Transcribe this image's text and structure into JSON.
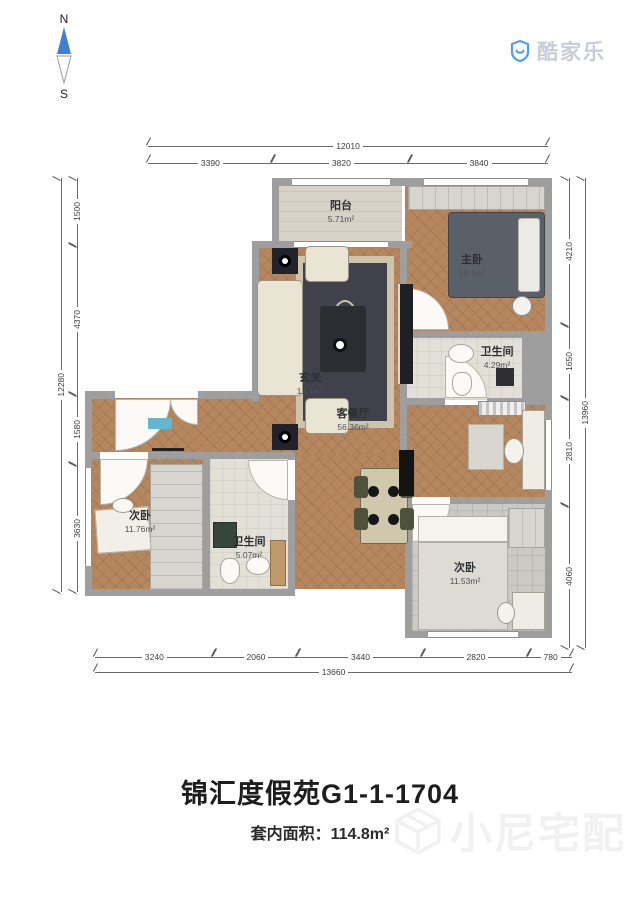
{
  "compass": {
    "north": "N",
    "south": "S"
  },
  "logo": {
    "text": "酷家乐"
  },
  "dimensions": {
    "top": {
      "total": "12010",
      "segments": [
        "3390",
        "3820",
        "3840"
      ]
    },
    "left": {
      "total": "12280",
      "segments": [
        "1500",
        "4370",
        "1580",
        "3630"
      ]
    },
    "right": {
      "total": "13960",
      "segments": [
        "4210",
        "1650",
        "2810",
        "4060"
      ]
    },
    "bottom": {
      "total": "13660",
      "segments": [
        "3240",
        "2060",
        "3440",
        "2820",
        "780"
      ]
    }
  },
  "rooms": [
    {
      "name": "阳台",
      "area": "5.71m²"
    },
    {
      "name": "主卧",
      "area": "18.1m²"
    },
    {
      "name": "卫生间",
      "area": "4.29m²"
    },
    {
      "name": "玄关",
      "area": "1.01m²"
    },
    {
      "name": "客餐厅",
      "area": "56.36m²"
    },
    {
      "name": "次卧",
      "area": "11.76m²"
    },
    {
      "name": "卫生间",
      "area": "5.07m²"
    },
    {
      "name": "次卧",
      "area": "11.53m²"
    }
  ],
  "footer": {
    "title": "锦汇度假苑G1-1-1704",
    "area_label": "套内面积：",
    "area_value": "114.8m²",
    "watermark": "小尼宅配"
  },
  "colors": {
    "compass_north": "#3f7fd8",
    "logo_blue": "#4da0f0",
    "wall_gray": "#9e9e9e",
    "wood_floor": "#b6875e"
  }
}
